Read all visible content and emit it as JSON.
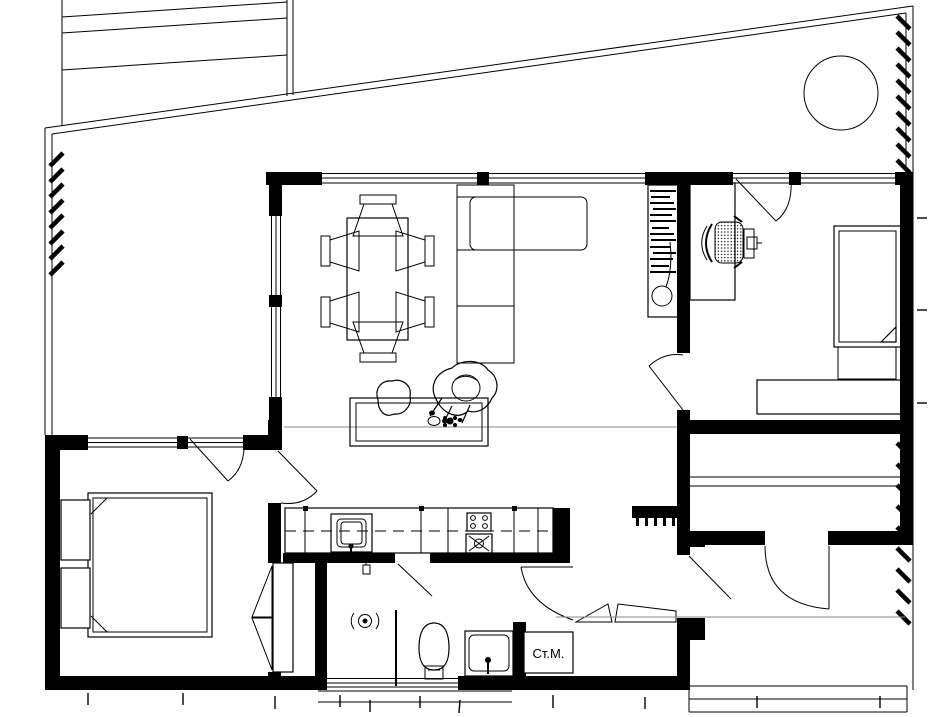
{
  "labels": {
    "washing_machine": "Ст.М."
  },
  "colors": {
    "line": "#000000",
    "background": "#ffffff",
    "refline": "#8a8a8a"
  }
}
